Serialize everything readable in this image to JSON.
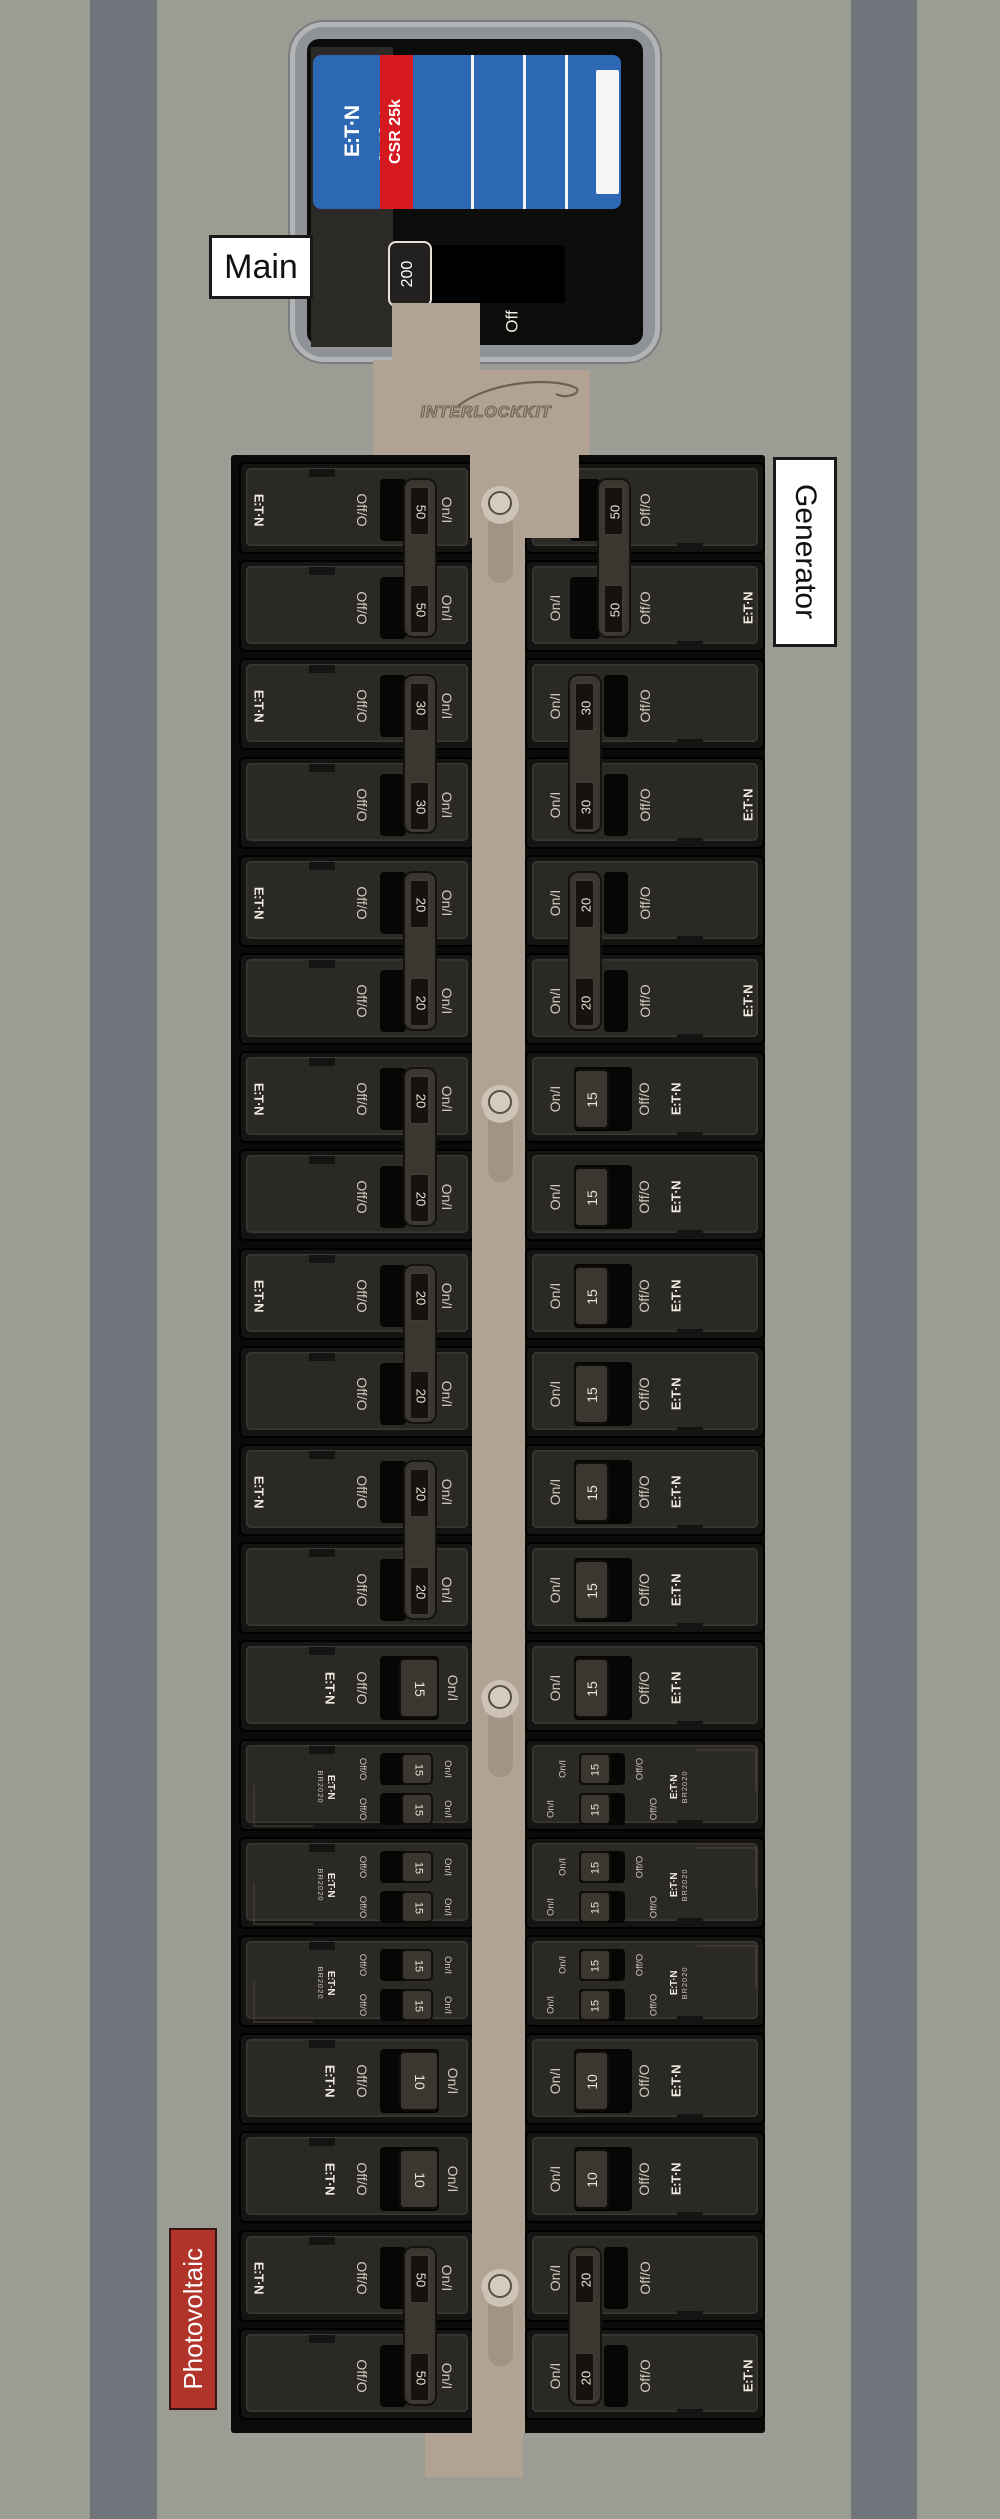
{
  "labels": {
    "main": "Main",
    "generator": "Generator",
    "photovoltaic": "Photovoltaic"
  },
  "main_breaker": {
    "brand": "E:T·N",
    "brand_sub": "Circuit Breaker",
    "model": "CSR 25k",
    "amp": "200",
    "off": "Off",
    "state": "on"
  },
  "interlock": {
    "brand": "INTERLOCKKIT"
  },
  "breaker_labels": {
    "on": "On/I",
    "off": "Off/O",
    "brand": "E:T·N",
    "tandem_model": "BR2020"
  },
  "colors": {
    "wall": "#9b9d94",
    "stud_stripe": "#6f757b",
    "panel_black": "#0a0a09",
    "label_blue": "#2d68b5",
    "label_red": "#d6191f",
    "pv_red": "#b0342a",
    "bracket_tan": "#b1a294"
  },
  "left_column": [
    {
      "kind": "pole",
      "role": "top",
      "amp": "50",
      "logo": true,
      "state": "on"
    },
    {
      "kind": "pole",
      "role": "bottom",
      "amp": "50",
      "logo": false,
      "state": "on"
    },
    {
      "kind": "pole",
      "role": "top",
      "amp": "30",
      "logo": true,
      "state": "on"
    },
    {
      "kind": "pole",
      "role": "bottom",
      "amp": "30",
      "logo": false,
      "state": "on"
    },
    {
      "kind": "pole",
      "role": "top",
      "amp": "20",
      "logo": true,
      "state": "on"
    },
    {
      "kind": "pole",
      "role": "bottom",
      "amp": "20",
      "logo": false,
      "state": "on"
    },
    {
      "kind": "pole",
      "role": "top",
      "amp": "20",
      "logo": true,
      "state": "on"
    },
    {
      "kind": "pole",
      "role": "bottom",
      "amp": "20",
      "logo": false,
      "state": "on"
    },
    {
      "kind": "pole",
      "role": "top",
      "amp": "20",
      "logo": true,
      "state": "on"
    },
    {
      "kind": "pole",
      "role": "bottom",
      "amp": "20",
      "logo": false,
      "state": "on"
    },
    {
      "kind": "pole",
      "role": "top",
      "amp": "20",
      "logo": true,
      "state": "on"
    },
    {
      "kind": "pole",
      "role": "bottom",
      "amp": "20",
      "logo": false,
      "state": "on"
    },
    {
      "kind": "single",
      "amp": "15",
      "logo": true,
      "state": "on"
    },
    {
      "kind": "tandem",
      "amps": [
        "15",
        "15"
      ],
      "state": "on"
    },
    {
      "kind": "tandem",
      "amps": [
        "15",
        "15"
      ],
      "state": "on"
    },
    {
      "kind": "tandem",
      "amps": [
        "15",
        "15"
      ],
      "state": "on"
    },
    {
      "kind": "single",
      "amp": "10",
      "logo": true,
      "state": "on"
    },
    {
      "kind": "single",
      "amp": "10",
      "logo": true,
      "state": "on"
    },
    {
      "kind": "pole",
      "role": "top",
      "amp": "50",
      "logo": true,
      "state": "on"
    },
    {
      "kind": "pole",
      "role": "bottom",
      "amp": "50",
      "logo": false,
      "state": "on"
    }
  ],
  "right_column": [
    {
      "kind": "pole",
      "role": "top",
      "amp": "50",
      "logo": false,
      "state": "off"
    },
    {
      "kind": "pole",
      "role": "bottom",
      "amp": "50",
      "logo": true,
      "state": "off"
    },
    {
      "kind": "pole",
      "role": "top",
      "amp": "30",
      "logo": false,
      "state": "on"
    },
    {
      "kind": "pole",
      "role": "bottom",
      "amp": "30",
      "logo": true,
      "state": "on"
    },
    {
      "kind": "pole",
      "role": "top",
      "amp": "20",
      "logo": false,
      "state": "on"
    },
    {
      "kind": "pole",
      "role": "bottom",
      "amp": "20",
      "logo": true,
      "state": "on"
    },
    {
      "kind": "single",
      "amp": "15",
      "logo": true,
      "state": "on"
    },
    {
      "kind": "single",
      "amp": "15",
      "logo": true,
      "state": "on"
    },
    {
      "kind": "single",
      "amp": "15",
      "logo": true,
      "state": "on"
    },
    {
      "kind": "single",
      "amp": "15",
      "logo": true,
      "state": "on"
    },
    {
      "kind": "single",
      "amp": "15",
      "logo": true,
      "state": "on"
    },
    {
      "kind": "single",
      "amp": "15",
      "logo": true,
      "state": "on"
    },
    {
      "kind": "single",
      "amp": "15",
      "logo": true,
      "state": "on"
    },
    {
      "kind": "tandem",
      "amps": [
        "15",
        "15"
      ],
      "state": "on"
    },
    {
      "kind": "tandem",
      "amps": [
        "15",
        "15"
      ],
      "state": "on"
    },
    {
      "kind": "tandem",
      "amps": [
        "15",
        "15"
      ],
      "state": "on"
    },
    {
      "kind": "single",
      "amp": "10",
      "logo": true,
      "state": "on"
    },
    {
      "kind": "single",
      "amp": "10",
      "logo": true,
      "state": "on"
    },
    {
      "kind": "pole",
      "role": "top",
      "amp": "20",
      "logo": false,
      "state": "on"
    },
    {
      "kind": "pole",
      "role": "bottom",
      "amp": "20",
      "logo": true,
      "state": "on"
    }
  ]
}
